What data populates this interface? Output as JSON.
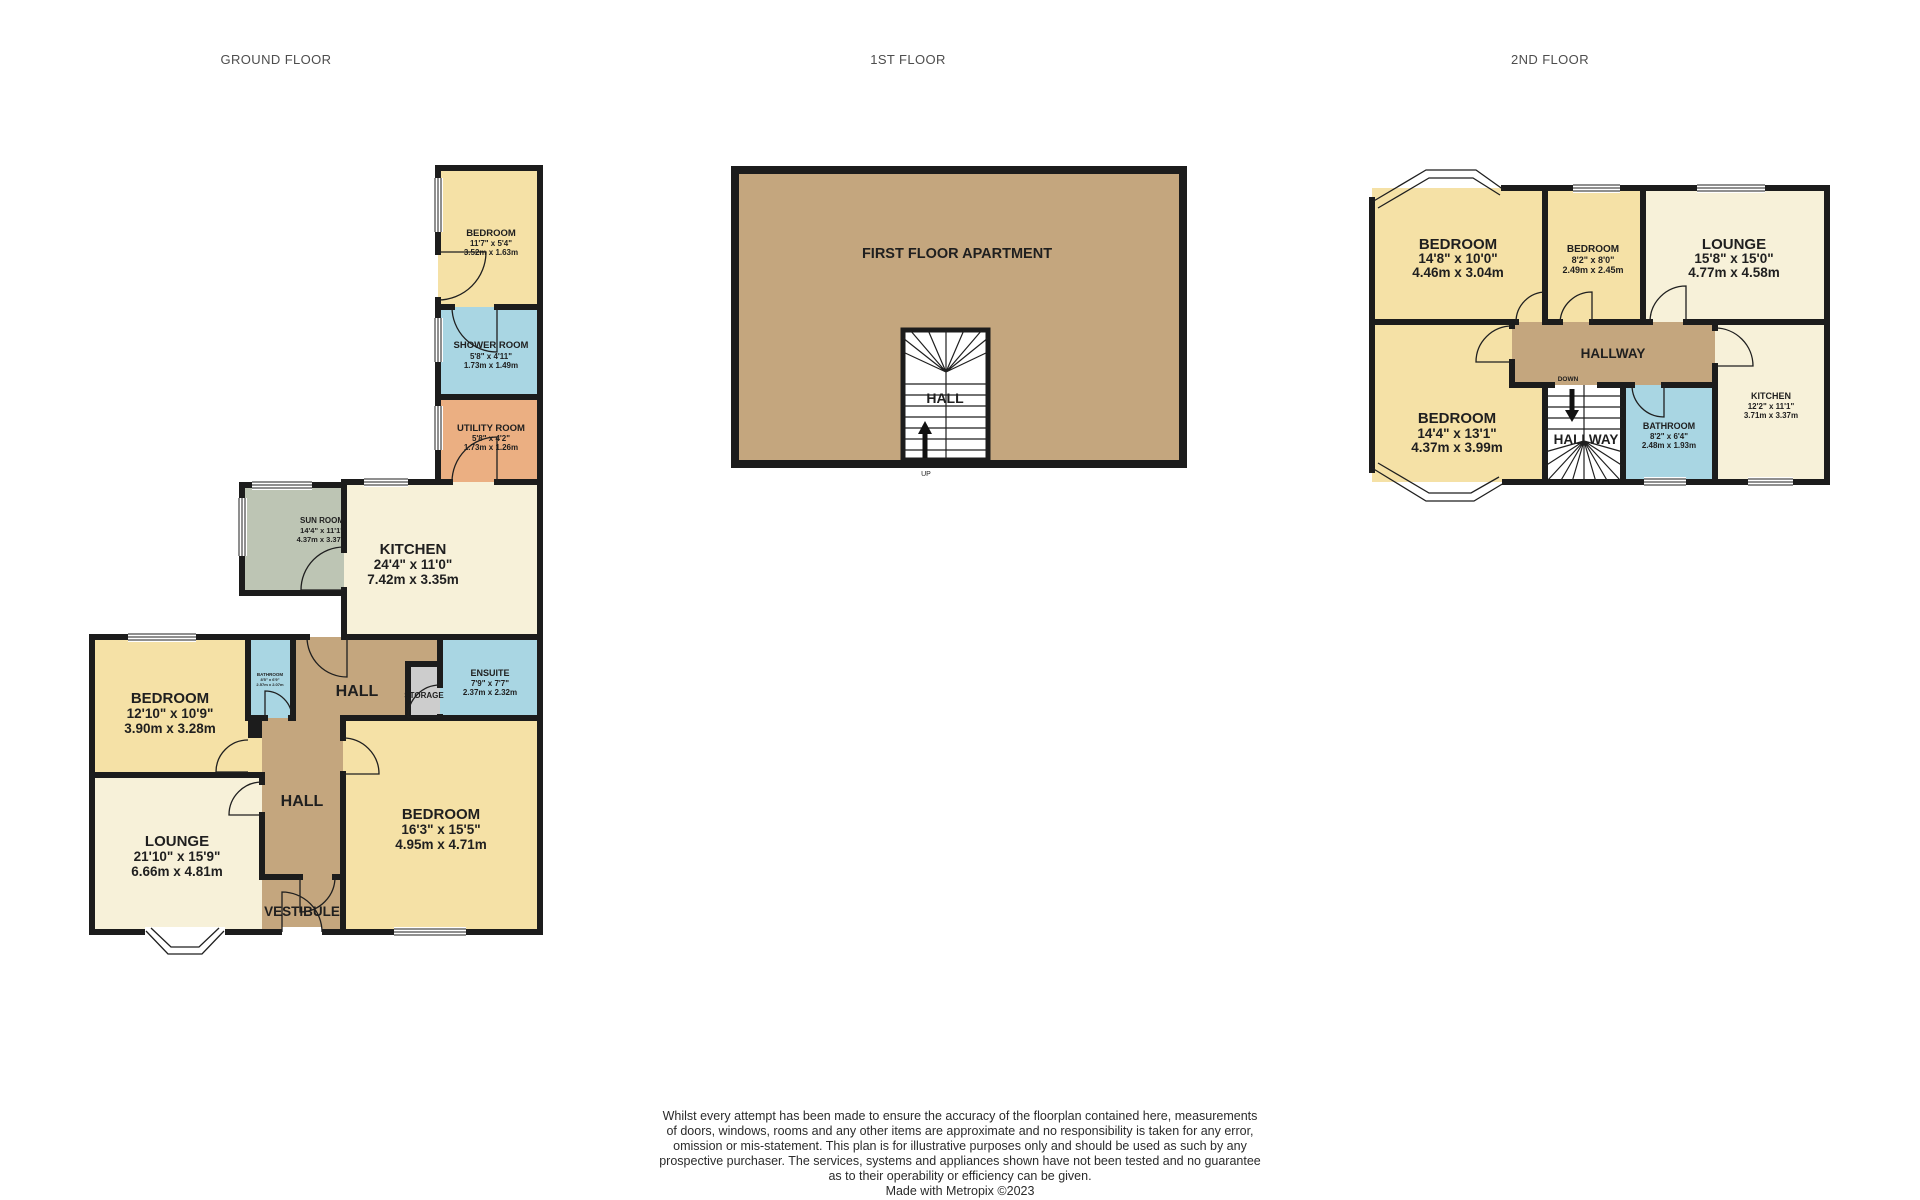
{
  "headers": {
    "ground": "GROUND FLOOR",
    "first": "1ST FLOOR",
    "second": "2ND FLOOR"
  },
  "ground_floor": {
    "bedroom_top": {
      "name": "BEDROOM",
      "imperial": "11'7\" x 5'4\"",
      "metric": "3.52m x 1.63m"
    },
    "shower_room": {
      "name": "SHOWER ROOM",
      "imperial": "5'8\" x 4'11\"",
      "metric": "1.73m x 1.49m"
    },
    "utility_room": {
      "name": "UTILITY ROOM",
      "imperial": "5'8\" x 4'2\"",
      "metric": "1.73m x 1.26m"
    },
    "sun_room": {
      "name": "SUN ROOM",
      "imperial": "14'4\" x 11'1\"",
      "metric": "4.37m x 3.37m"
    },
    "kitchen": {
      "name": "KITCHEN",
      "imperial": "24'4\" x 11'0\"",
      "metric": "7.42m x 3.35m"
    },
    "bedroom_left": {
      "name": "BEDROOM",
      "imperial": "12'10\" x 10'9\"",
      "metric": "3.90m x 3.28m"
    },
    "bathroom": {
      "name": "BATHROOM",
      "imperial": "8'5\" x 6'9\"",
      "metric": "2.57m x 2.07m"
    },
    "hall_upper": {
      "name": "HALL"
    },
    "storage": {
      "name": "STORAGE"
    },
    "ensuite": {
      "name": "ENSUITE",
      "imperial": "7'9\" x 7'7\"",
      "metric": "2.37m x 2.32m"
    },
    "hall": {
      "name": "HALL"
    },
    "lounge": {
      "name": "LOUNGE",
      "imperial": "21'10\" x 15'9\"",
      "metric": "6.66m x 4.81m"
    },
    "vestibule": {
      "name": "VESTIBULE"
    },
    "bedroom_main": {
      "name": "BEDROOM",
      "imperial": "16'3\" x 15'5\"",
      "metric": "4.95m x 4.71m"
    }
  },
  "first_floor": {
    "apartment": {
      "name": "FIRST FLOOR APARTMENT"
    },
    "hall": {
      "name": "HALL"
    },
    "up_label": "UP"
  },
  "second_floor": {
    "bedroom_top_left": {
      "name": "BEDROOM",
      "imperial": "14'8\" x 10'0\"",
      "metric": "4.46m x 3.04m"
    },
    "bedroom_top_middle": {
      "name": "BEDROOM",
      "imperial": "8'2\" x 8'0\"",
      "metric": "2.49m x 2.45m"
    },
    "lounge": {
      "name": "LOUNGE",
      "imperial": "15'8\" x 15'0\"",
      "metric": "4.77m x 4.58m"
    },
    "hallway": {
      "name": "HALLWAY"
    },
    "bedroom_bottom_left": {
      "name": "BEDROOM",
      "imperial": "14'4\" x 13'1\"",
      "metric": "4.37m x 3.99m"
    },
    "hallway_stairs": {
      "name": "HALLWAY"
    },
    "down_label": "DOWN",
    "bathroom": {
      "name": "BATHROOM",
      "imperial": "8'2\" x 6'4\"",
      "metric": "2.48m x 1.93m"
    },
    "kitchen": {
      "name": "KITCHEN",
      "imperial": "12'2\" x 11'1\"",
      "metric": "3.71m x 3.37m"
    }
  },
  "footer": {
    "disclaimer_lines": [
      "Whilst every attempt has been made to ensure the accuracy of the floorplan contained here, measurements",
      "of doors, windows, rooms and any other items are approximate and no responsibility is taken for any error,",
      "omission or mis-statement. This plan is for illustrative purposes only and should be used as such by any",
      "prospective purchaser. The services, systems and appliances shown have not been tested and no guarantee",
      "as to their operability or efficiency can be given."
    ],
    "credit": "Made with Metropix ©2023"
  },
  "colors": {
    "room_yellow": "#F5E1A6",
    "room_cream": "#F7F1D9",
    "room_blue": "#A9D6E3",
    "room_orange": "#EBAF82",
    "room_tan": "#C4A67E",
    "room_sage": "#BDC5B4",
    "room_grey": "#CDCDCD",
    "wall": "#1C1C1C"
  }
}
